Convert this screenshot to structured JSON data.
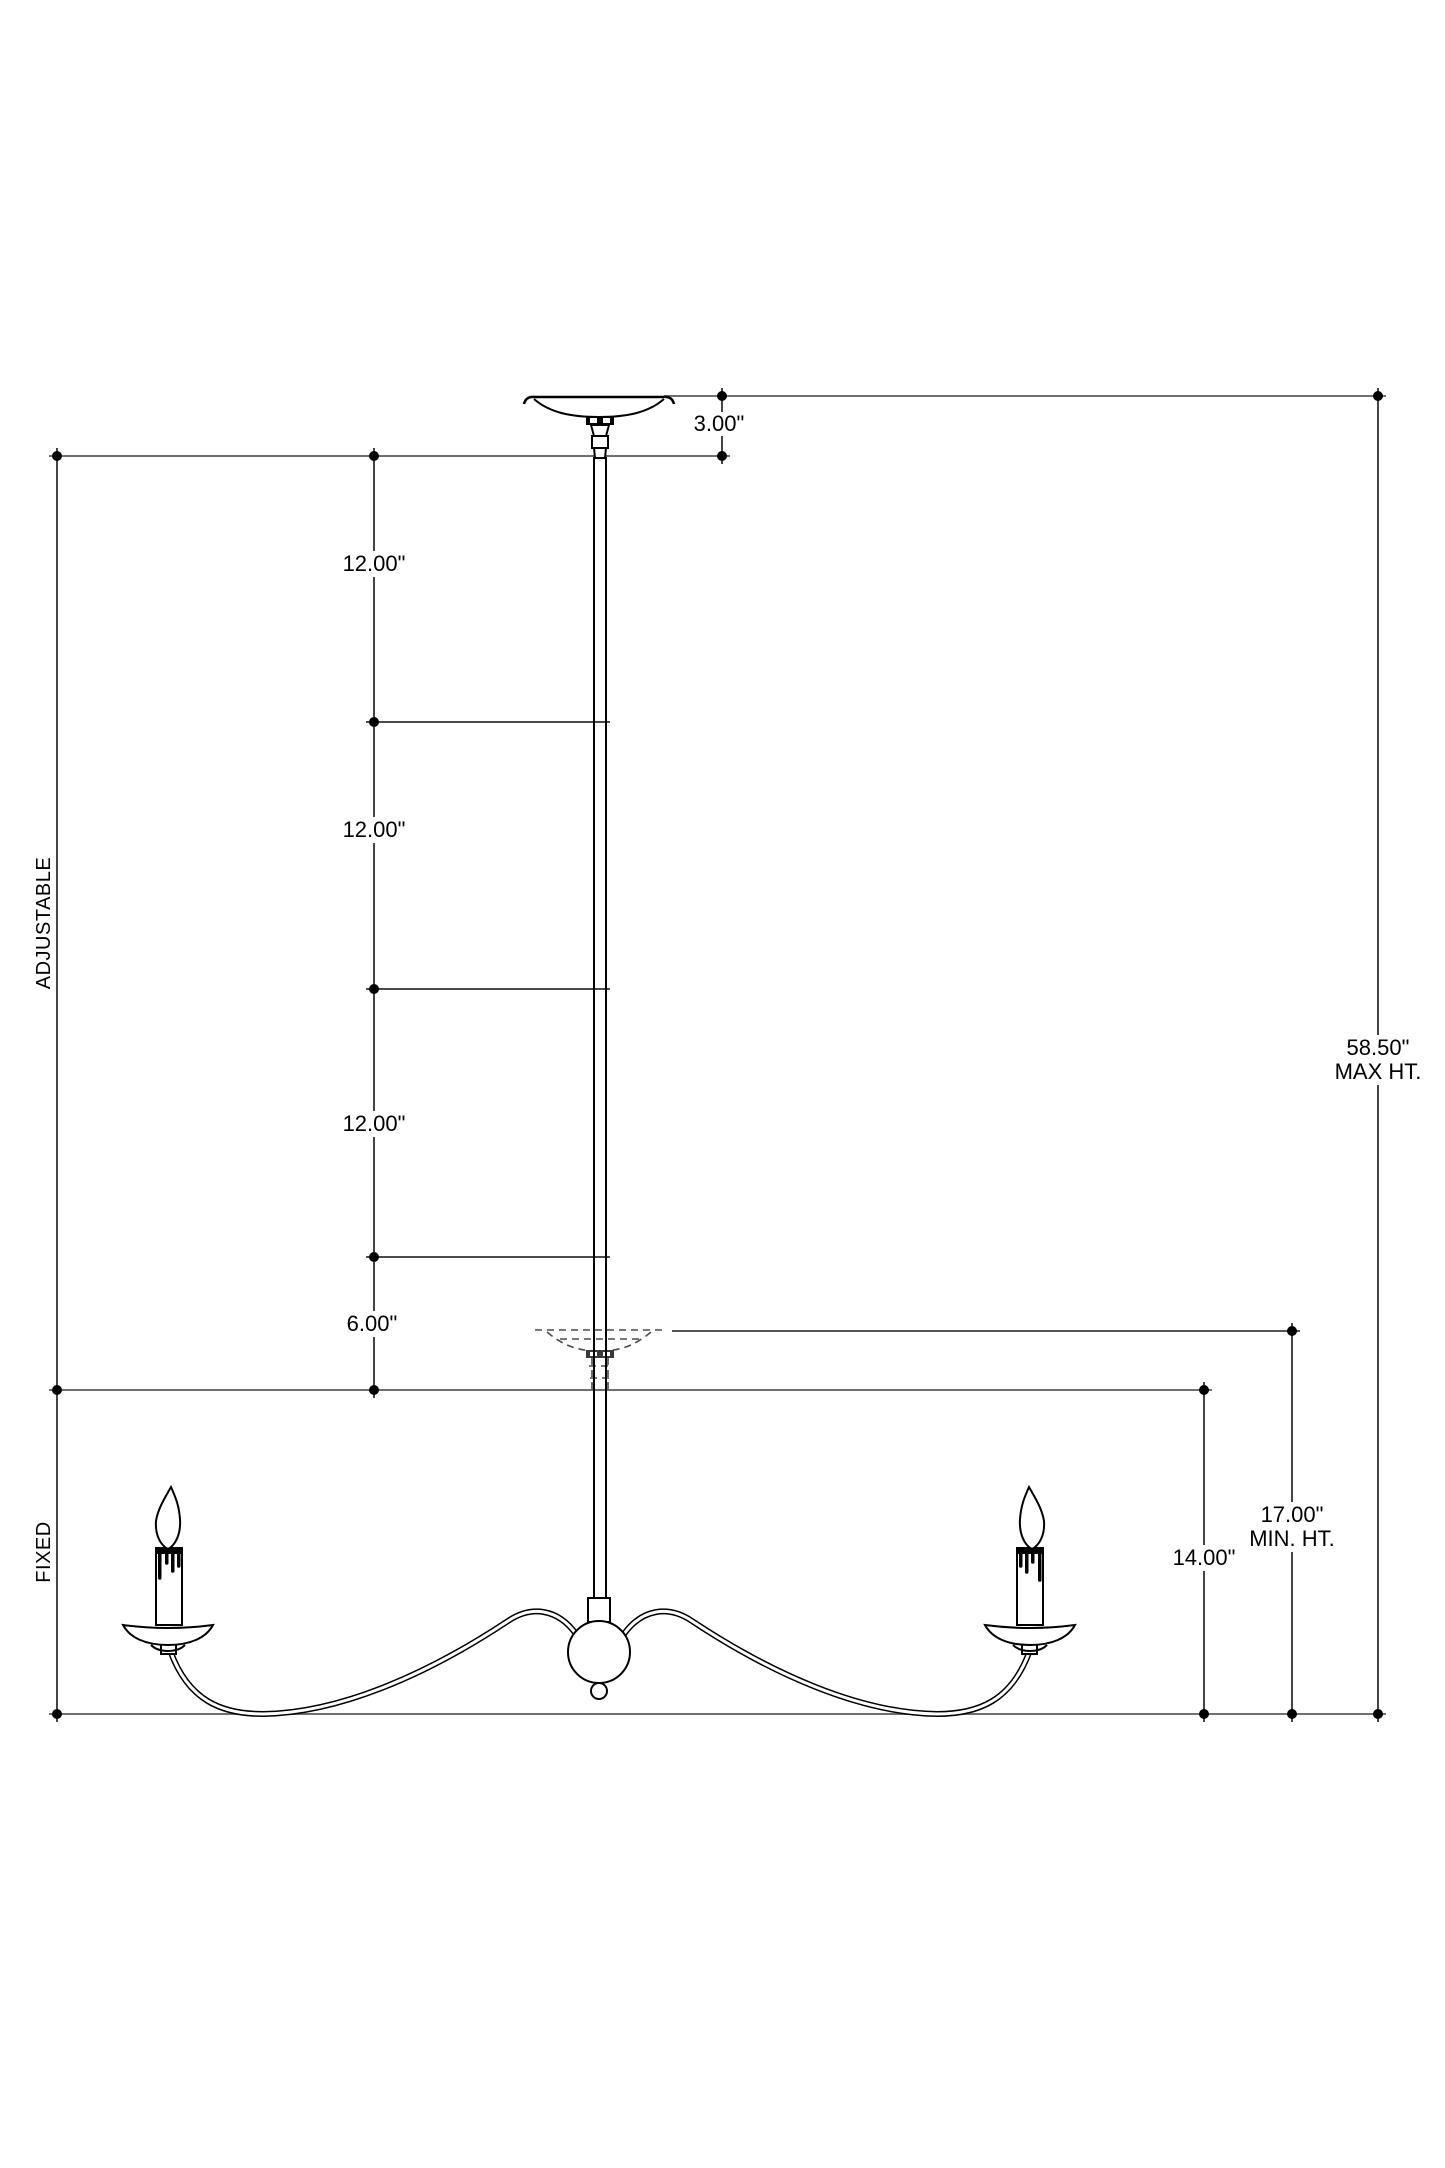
{
  "drawing": {
    "dimensions": {
      "canopy_drop": "3.00\"",
      "rod_segment_1": "12.00\"",
      "rod_segment_2": "12.00\"",
      "rod_segment_3": "12.00\"",
      "rod_segment_4": "6.00\"",
      "max_height_value": "58.50\"",
      "max_height_label": "MAX HT.",
      "min_height_value": "17.00\"",
      "min_height_label": "MIN. HT.",
      "fixed_height": "14.00\""
    },
    "sections": {
      "adjustable": "ADJUSTABLE",
      "fixed": "FIXED"
    },
    "colors": {
      "background": "#ffffff",
      "fixture_line": "#000000",
      "dimension_line": "#303030",
      "reference_line": "#6e6e6e",
      "phantom_line": "#4a4a4a",
      "text": "#000000"
    }
  }
}
